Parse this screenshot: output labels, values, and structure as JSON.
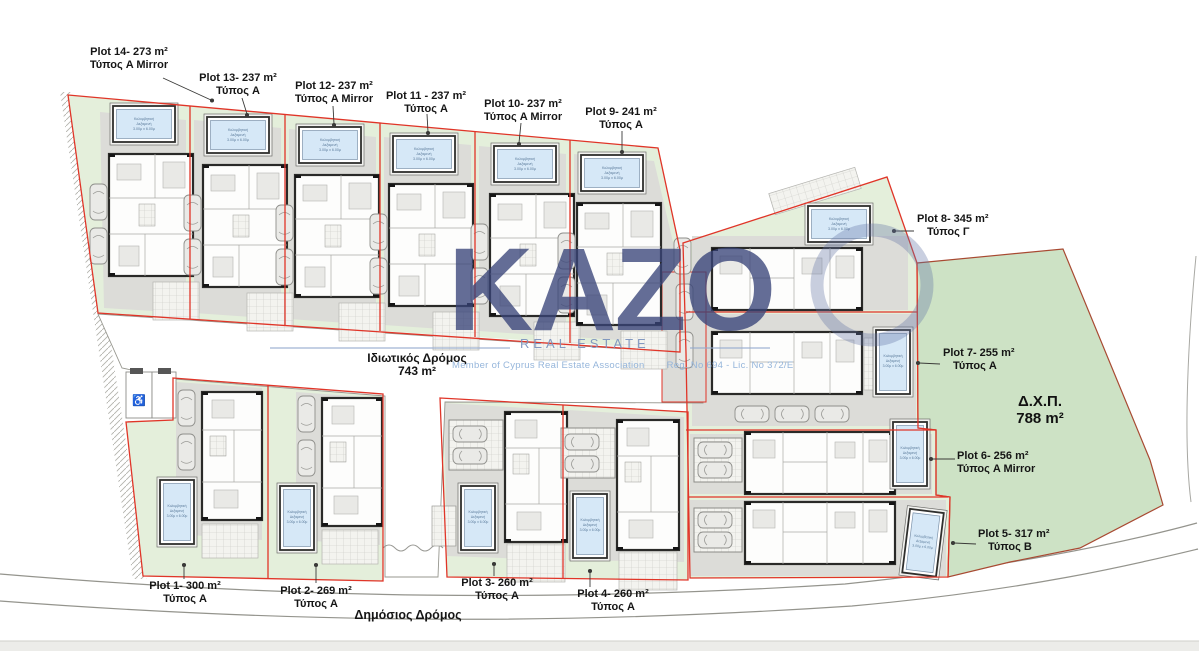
{
  "title": "Residential development site plan",
  "watermark": {
    "brand": "KAZO",
    "subtitle": "REAL ESTATE",
    "membership": "Member of Cyprus Real Estate Association",
    "license": "Reg. No 694 - Lic. No 372/E"
  },
  "roads": {
    "private_name": "Ιδιωτικός Δρόμος",
    "private_area": "743 m²",
    "public_name": "Δημόσιος Δρόμος"
  },
  "green_space": {
    "code": "Δ.Χ.Π.",
    "area": "788 m²"
  },
  "pool": {
    "line1": "Κολυμβητική",
    "line2": "Δεξαμενή",
    "line3": "3.00μ x 6.00μ"
  },
  "accessible_parking": {
    "symbol": "♿"
  },
  "colors": {
    "plot_boundary": "#e03528",
    "lawn": "#e4efdb",
    "green_space": "#cde2c5",
    "pool_water": "#d6e8f7",
    "watermark_navy": "#384478"
  },
  "plots": [
    {
      "id": "1",
      "label": "Plot 1- 300 m²",
      "type": "Τύπος A"
    },
    {
      "id": "2",
      "label": "Plot 2- 269 m²",
      "type": "Τύπος A"
    },
    {
      "id": "3",
      "label": "Plot 3- 260 m²",
      "type": "Τύπος A"
    },
    {
      "id": "4",
      "label": "Plot 4- 260 m²",
      "type": "Τύπος A"
    },
    {
      "id": "5",
      "label": "Plot 5- 317 m²",
      "type": "Τύπος B"
    },
    {
      "id": "6",
      "label": "Plot 6- 256 m²",
      "type": "Τύπος A Mirror"
    },
    {
      "id": "7",
      "label": "Plot 7- 255 m²",
      "type": "Τύπος A"
    },
    {
      "id": "8",
      "label": "Plot 8- 345 m²",
      "type": "Τύπος Γ"
    },
    {
      "id": "9",
      "label": "Plot 9- 241 m²",
      "type": "Τύπος A"
    },
    {
      "id": "10",
      "label": "Plot 10- 237 m²",
      "type": "Τύπος A Mirror"
    },
    {
      "id": "11",
      "label": "Plot 11 - 237 m²",
      "type": "Τύπος A"
    },
    {
      "id": "12",
      "label": "Plot 12- 237 m²",
      "type": "Τύπος A Mirror"
    },
    {
      "id": "13",
      "label": "Plot 13- 237 m²",
      "type": "Τύπος A"
    },
    {
      "id": "14",
      "label": "Plot 14- 273 m²",
      "type": "Τύπος A Mirror"
    }
  ]
}
